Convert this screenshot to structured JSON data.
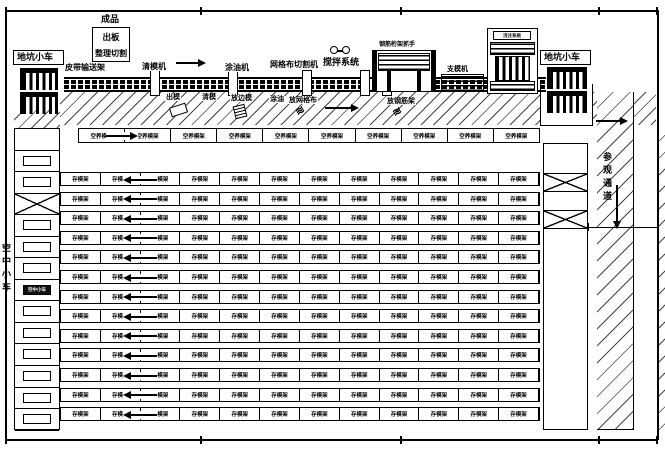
{
  "line": {
    "finished": "成品",
    "out_board": "出板",
    "trim_cut": "整理切割",
    "belt": "皮带输送架",
    "pit_car_left": "地坑小车",
    "pit_car_right": "地坑小车",
    "mold_cleaner": "清模机",
    "oiler": "涂油机",
    "mesh_cutter": "网格布切割机",
    "mixer": "搅拌系统",
    "gripper": "钢筋桁架抓手",
    "mold_setter": "支模机",
    "caster": "浇注系统"
  },
  "band": {
    "demold": "出模",
    "clean": "清模",
    "side_mold": "放边模",
    "oil": "涂油",
    "mesh": "放网格布",
    "rebar": "放钢筋架"
  },
  "aerial": {
    "lane_label": "空中小车",
    "car_label": "空中小车"
  },
  "corridor": {
    "label": "参观通道"
  },
  "curing": {
    "empty_row_cell": "空养模架",
    "empty_row_cells": 10,
    "storage_cell": "存模架",
    "storage_rows": 13,
    "storage_cols": 12
  }
}
